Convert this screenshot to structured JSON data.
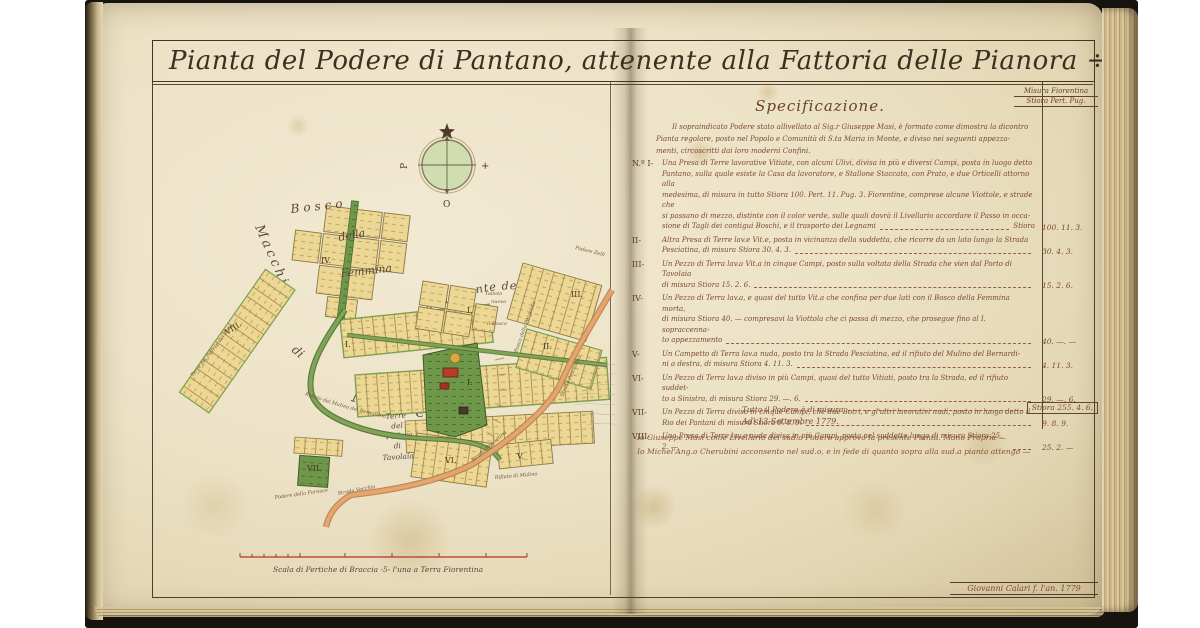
{
  "title": "Pianta del Podere di Pantano, attenente alla Fattoria delle Pianora ÷",
  "corner_note": {
    "line1": "Misura Fiorentina",
    "line2": "Stiora  Pert.  Pug."
  },
  "spec": {
    "heading": "Specificazione.",
    "intro": [
      "Il sopraindicato Podere stato allivellato al Sig.r Giuseppe Masi, è formato come dimostra la dicontro",
      "Pianta regolare, posto nel Popolo e Comunità di S.ta Maria in Monte, e diviso nei seguenti appezza-",
      "menti, circoscritti dai loro moderni Confini."
    ],
    "items": [
      {
        "numeral": "N.º I-",
        "lines": [
          "Una Presa di Terre lavorative Vitiate, con alcuni Ulivi, divisa in più e diversi Campi, posta in luogo detto",
          "Pantano, sulla quale esiste la Casa da lavoratore, e Stallone Staccato, con Prato, e due Orticelli attorno alla",
          "medesima, di misura in tutto Stiora 100. Pert. 11. Pug. 3. Fiorentine, comprese alcune Viottole, e strade che",
          "si passano di mezzo, distinte con il color verde, sulle quali dovrà il Livellario accordare il Passo in occa-",
          "sione di Tagli dei contigui Boschi, e il trasporto dei Legnami"
        ],
        "value_prefix": "Stiora",
        "value": "100. 11. 3."
      },
      {
        "numeral": "II-",
        "lines": [
          "Altra Presa di Terre lav.e Vit.e, posta in vicinanza della suddetta, che ricorre da un lato lungo la Strada",
          "Pesciatina, di misura Stiora 30. 4. 3."
        ],
        "value_prefix": "",
        "value": "30. 4. 3."
      },
      {
        "numeral": "III-",
        "lines": [
          "Un Pezzo di Terra lav.a Vit.a in cinque Campi, posto sulla voltata della Strada che vien dal Porto di Tavolaia",
          "di misura Stiora 15. 2. 6."
        ],
        "value_prefix": "",
        "value": "15. 2. 6."
      },
      {
        "numeral": "IV-",
        "lines": [
          "Un Pezzo di Terra lav.a, e quasi del tutto Vit.a che confina per due lati con il Bosco della Femmina morta,",
          "di misura Stiora 40. — compresavi la Viottola che ci passa di mezzo, che prosegue fino al I. sopraccenna-",
          "to appezzamento"
        ],
        "value_prefix": "",
        "value": "40. —. —"
      },
      {
        "numeral": "V-",
        "lines": [
          "Un Campetto di Terra lav.a nuda, posto tra la Strada Pesciatina, ed il rifiuto del Mulino del Bernardi-",
          "ni a destra, di misura Stiora 4. 11. 3."
        ],
        "value_prefix": "",
        "value": "4. 11. 3."
      },
      {
        "numeral": "VI-",
        "lines": [
          "Un Pezzo di Terra lav.a diviso in più Campi, quasi del tutto Vitiati, posto tra la Strada, ed il rifiuto suddet-",
          "to a Sinistra, di misura Stiora 29. —. 6."
        ],
        "value_prefix": "",
        "value": "29. —. 6."
      },
      {
        "numeral": "VII-",
        "lines": [
          "Un Pezzo di Terra diviso in cinque Campi, che due Botri, e gl'altri lavorativi nudi, posto in luogo detto il",
          "Rio dei Pantani di misura Stiora 9. 8. 9."
        ],
        "value_prefix": "",
        "value": "9. 8. 9."
      },
      {
        "numeral": "VIII-",
        "lines": [
          "Una Presa di Terre lav.e nude divisa in più Campi, posta nel suddetto luogo di misura Stiora 25. 2. —"
        ],
        "value_prefix": "",
        "value": "25. 2. —"
      }
    ],
    "total_label": "Tutto il Podere è di misura",
    "total_value": "Stiora  255. 4. 6.",
    "date_line": "Adì 13 Settembre 1779.",
    "signatures": [
      "Io Giuseppe Masi come Livellario del sud.o Podere approvo la presente Pianta. Mano Propria —",
      "Io Michel'Ang.o Cherubini acconsento nel sud.o, e in fede di quanto sopra alla sud.a pianta attengo —"
    ],
    "cartographer": "Giovanni Calari f. l'an. 1779"
  },
  "map": {
    "labels": {
      "bosco": "Bosco",
      "della": "della",
      "femmina": "Femmina",
      "morta": "Morta.",
      "macchia": "Macchia",
      "di": "di",
      "montemurlo": "Montemurlo.",
      "fonte": "Bosco della Fonte del Pantano",
      "pergolaia": "Bosco della Pergolaia",
      "podere_zelli": "Podere Zelli",
      "pesciatina": "Strada Pesciatina",
      "pesciatina2": "Strada Pesciatina",
      "vecchia": "Strada Vecchia",
      "talleto": "Talleto",
      "nuovo": "nuovo",
      "il_bosco": "il Bosco",
      "tav1": "Terre",
      "tav2": "del",
      "tav3": "Podere",
      "tav4": "di",
      "tav5": "Tavolaia",
      "rif_bern": "Rifiuto del Mulino del Bernardini",
      "rif_mul": "Rifiuto di Mulino",
      "terre_pino": "Terre del Podere del Pino",
      "fornace": "Podere della Fornace"
    },
    "numerals": {
      "iv": "IV.",
      "viii": "VIII.",
      "vii": "VII.",
      "vi": "VI.",
      "v": "V.",
      "iii": "III.",
      "ii": "II.",
      "i_talleto": "I.",
      "i_casa": "I.",
      "i_band": "I."
    },
    "compass": {
      "west": "P",
      "east": "+",
      "south": "O"
    },
    "scale_caption": "Scala di Pertiche di Braccia -5- l'una a Terra Fiorentina"
  }
}
